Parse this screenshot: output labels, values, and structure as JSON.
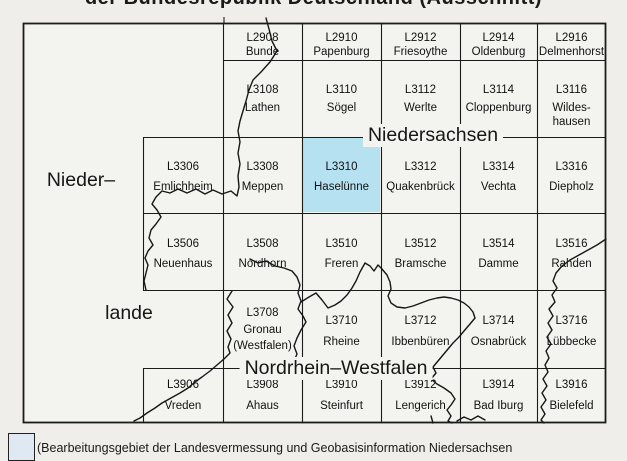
{
  "title": {
    "text": "der Bundesrepublik Deutschland (Ausschnitt)"
  },
  "map": {
    "highlight_color": "#b6e1f1",
    "region_labels": [
      {
        "id": "niedersachsen",
        "text": "Niedersachsen"
      },
      {
        "id": "nordrhein-westfalen",
        "text": "Nordrhein–Westfalen"
      },
      {
        "id": "niederlande-line1",
        "text": "Nieder–"
      },
      {
        "id": "niederlande-line2",
        "text": "lande"
      }
    ],
    "cells": [
      {
        "sheet": "L2908",
        "name_lines": [
          "Bunde"
        ],
        "row": 0,
        "col": 1,
        "highlighted": false
      },
      {
        "sheet": "L2910",
        "name_lines": [
          "Papenburg"
        ],
        "row": 0,
        "col": 2,
        "highlighted": false
      },
      {
        "sheet": "L2912",
        "name_lines": [
          "Friesoythe"
        ],
        "row": 0,
        "col": 3,
        "highlighted": false
      },
      {
        "sheet": "L2914",
        "name_lines": [
          "Oldenburg"
        ],
        "row": 0,
        "col": 4,
        "highlighted": false
      },
      {
        "sheet": "L2916",
        "name_lines": [
          "Delmenhorst"
        ],
        "row": 0,
        "col": 5,
        "highlighted": false
      },
      {
        "sheet": "L3108",
        "name_lines": [
          "Lathen"
        ],
        "row": 1,
        "col": 1,
        "highlighted": false
      },
      {
        "sheet": "L3110",
        "name_lines": [
          "Sögel"
        ],
        "row": 1,
        "col": 2,
        "highlighted": false
      },
      {
        "sheet": "L3112",
        "name_lines": [
          "Werlte"
        ],
        "row": 1,
        "col": 3,
        "highlighted": false
      },
      {
        "sheet": "L3114",
        "name_lines": [
          "Cloppenburg"
        ],
        "row": 1,
        "col": 4,
        "highlighted": false
      },
      {
        "sheet": "L3116",
        "name_lines": [
          "Wildes-",
          "hausen"
        ],
        "row": 1,
        "col": 5,
        "highlighted": false
      },
      {
        "sheet": "L3306",
        "name_lines": [
          "Emlichheim"
        ],
        "row": 2,
        "col": 0,
        "highlighted": false
      },
      {
        "sheet": "L3308",
        "name_lines": [
          "Meppen"
        ],
        "row": 2,
        "col": 1,
        "highlighted": false
      },
      {
        "sheet": "L3310",
        "name_lines": [
          "Haselünne"
        ],
        "row": 2,
        "col": 2,
        "highlighted": true
      },
      {
        "sheet": "L3312",
        "name_lines": [
          "Quakenbrück"
        ],
        "row": 2,
        "col": 3,
        "highlighted": false
      },
      {
        "sheet": "L3314",
        "name_lines": [
          "Vechta"
        ],
        "row": 2,
        "col": 4,
        "highlighted": false
      },
      {
        "sheet": "L3316",
        "name_lines": [
          "Diepholz"
        ],
        "row": 2,
        "col": 5,
        "highlighted": false
      },
      {
        "sheet": "L3506",
        "name_lines": [
          "Neuenhaus"
        ],
        "row": 3,
        "col": 0,
        "highlighted": false
      },
      {
        "sheet": "L3508",
        "name_lines": [
          "Nordhorn"
        ],
        "row": 3,
        "col": 1,
        "highlighted": false
      },
      {
        "sheet": "L3510",
        "name_lines": [
          "Freren"
        ],
        "row": 3,
        "col": 2,
        "highlighted": false
      },
      {
        "sheet": "L3512",
        "name_lines": [
          "Bramsche"
        ],
        "row": 3,
        "col": 3,
        "highlighted": false
      },
      {
        "sheet": "L3514",
        "name_lines": [
          "Damme"
        ],
        "row": 3,
        "col": 4,
        "highlighted": false
      },
      {
        "sheet": "L3516",
        "name_lines": [
          "Rahden"
        ],
        "row": 3,
        "col": 5,
        "highlighted": false
      },
      {
        "sheet": "L3708",
        "name_lines": [
          "Gronau",
          "(Westfalen)"
        ],
        "row": 4,
        "col": 1,
        "highlighted": false
      },
      {
        "sheet": "L3710",
        "name_lines": [
          "Rheine"
        ],
        "row": 4,
        "col": 2,
        "highlighted": false
      },
      {
        "sheet": "L3712",
        "name_lines": [
          "Ibbenbüren"
        ],
        "row": 4,
        "col": 3,
        "highlighted": false
      },
      {
        "sheet": "L3714",
        "name_lines": [
          "Osnabrück"
        ],
        "row": 4,
        "col": 4,
        "highlighted": false
      },
      {
        "sheet": "L3716",
        "name_lines": [
          "Lübbecke"
        ],
        "row": 4,
        "col": 5,
        "highlighted": false
      },
      {
        "sheet": "L3906",
        "name_lines": [
          "Vreden"
        ],
        "row": 5,
        "col": 0,
        "highlighted": false
      },
      {
        "sheet": "L3908",
        "name_lines": [
          "Ahaus"
        ],
        "row": 5,
        "col": 1,
        "highlighted": false
      },
      {
        "sheet": "L3910",
        "name_lines": [
          "Steinfurt"
        ],
        "row": 5,
        "col": 2,
        "highlighted": false
      },
      {
        "sheet": "L3912",
        "name_lines": [
          "Lengerich"
        ],
        "row": 5,
        "col": 3,
        "highlighted": false
      },
      {
        "sheet": "L3914",
        "name_lines": [
          "Bad Iburg"
        ],
        "row": 5,
        "col": 4,
        "highlighted": false
      },
      {
        "sheet": "L3916",
        "name_lines": [
          "Bielefeld"
        ],
        "row": 5,
        "col": 5,
        "highlighted": false
      }
    ]
  },
  "legend": {
    "swatch_color": "#dfe9f3",
    "text": "(Bearbeitungsgebiet der Landesvermessung und Geobasisinformation Niedersachsen"
  }
}
